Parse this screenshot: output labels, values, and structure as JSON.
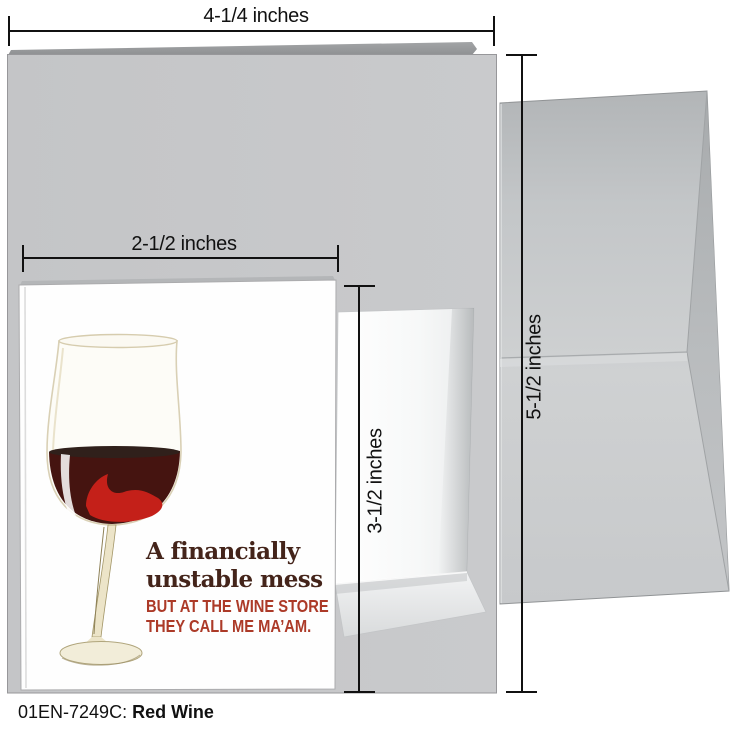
{
  "product": {
    "footer_code": "01EN-7249C:",
    "footer_title": "Red Wine"
  },
  "measurements": {
    "folder_width": "4-1/4 inches",
    "folder_height": "5-1/2 inches",
    "note_width": "2-1/2 inches",
    "note_height": "3-1/2 inches"
  },
  "card": {
    "headline_line1": "A financially",
    "headline_line2": "unstable mess",
    "tagline_line1": "BUT AT THE WINE STORE",
    "tagline_line2": "THEY CALL ME MA’AM."
  },
  "icons": {
    "illustration": "red-wine-glass"
  },
  "colors": {
    "headline": "#44241a",
    "tagline": "#ac3a28",
    "wine_dark": "#451410",
    "wine_surface": "#30201b",
    "wine_bright": "#c42019",
    "glass_cream": "#d9d0b5",
    "card_gray": "#c6c7c9",
    "envelope_gray": "#c9cbcd",
    "measure_black": "#111111",
    "footer_black": "#111111"
  }
}
